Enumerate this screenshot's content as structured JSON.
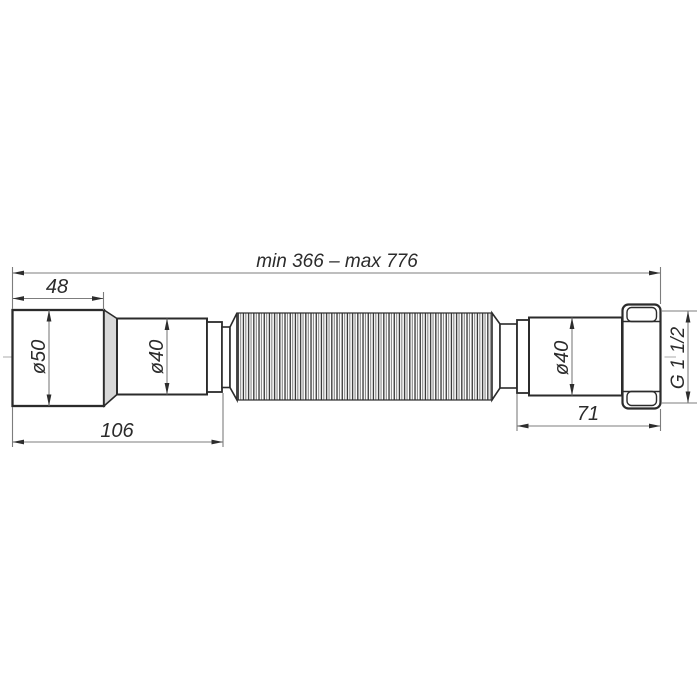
{
  "drawing_labels": {
    "overall_length": "min 366 – max 776",
    "inlet_length": "48",
    "inlet_diameter": "ø50",
    "left_pipe_diameter": "ø40",
    "left_section_length": "106",
    "right_pipe_diameter": "ø40",
    "right_section_length": "71",
    "thread_size": "G 1 1/2"
  },
  "colors": {
    "outline": "#2b2b2b",
    "dimension_line": "#7d7d7d",
    "centerline": "#bcbcbc",
    "chamfer_shading": "#d8d8d8",
    "background": "#ffffff"
  }
}
